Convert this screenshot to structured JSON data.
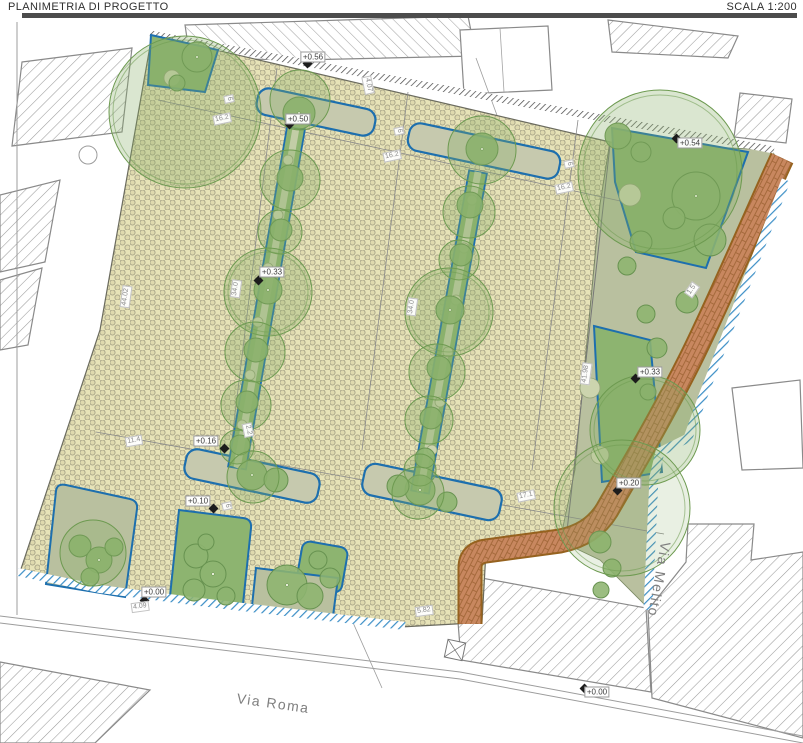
{
  "header": {
    "title": "PLANIMETRIA DI PROGETTO",
    "scale": "SCALA 1:200"
  },
  "streets": [
    {
      "name": "Via Roma"
    },
    {
      "name": "Via Melito"
    }
  ],
  "spot_elevations": [
    "+0.56",
    "+0.50",
    "+0.54",
    "+0.33",
    "+0.33",
    "+0.16",
    "+0.10",
    "+0.20",
    "+0.00",
    "+0.00"
  ],
  "dimensions": [
    "16.2",
    "6",
    "16.2",
    "6",
    "16.2",
    "6",
    "4.07",
    "44.02",
    "34.0",
    "34.0",
    "41.98",
    "11.4",
    "2.2",
    "17.1",
    "1.5",
    "4.09",
    "5.82",
    "6"
  ],
  "colors": {
    "paving": "#e7e3b8",
    "paving_dot": "#a8a488",
    "green_bed": "#8db470",
    "bed_border": "#1d6fae",
    "garden": "#b9c09f",
    "tree_canopy": "#6d9a50",
    "path_brick": "#c8875f",
    "path_border": "#96621f",
    "sidewalk_hatch_blue": "#3a8ec6",
    "building_hatch": "#9b9b9b",
    "header_bar": "#4c4c4c"
  }
}
